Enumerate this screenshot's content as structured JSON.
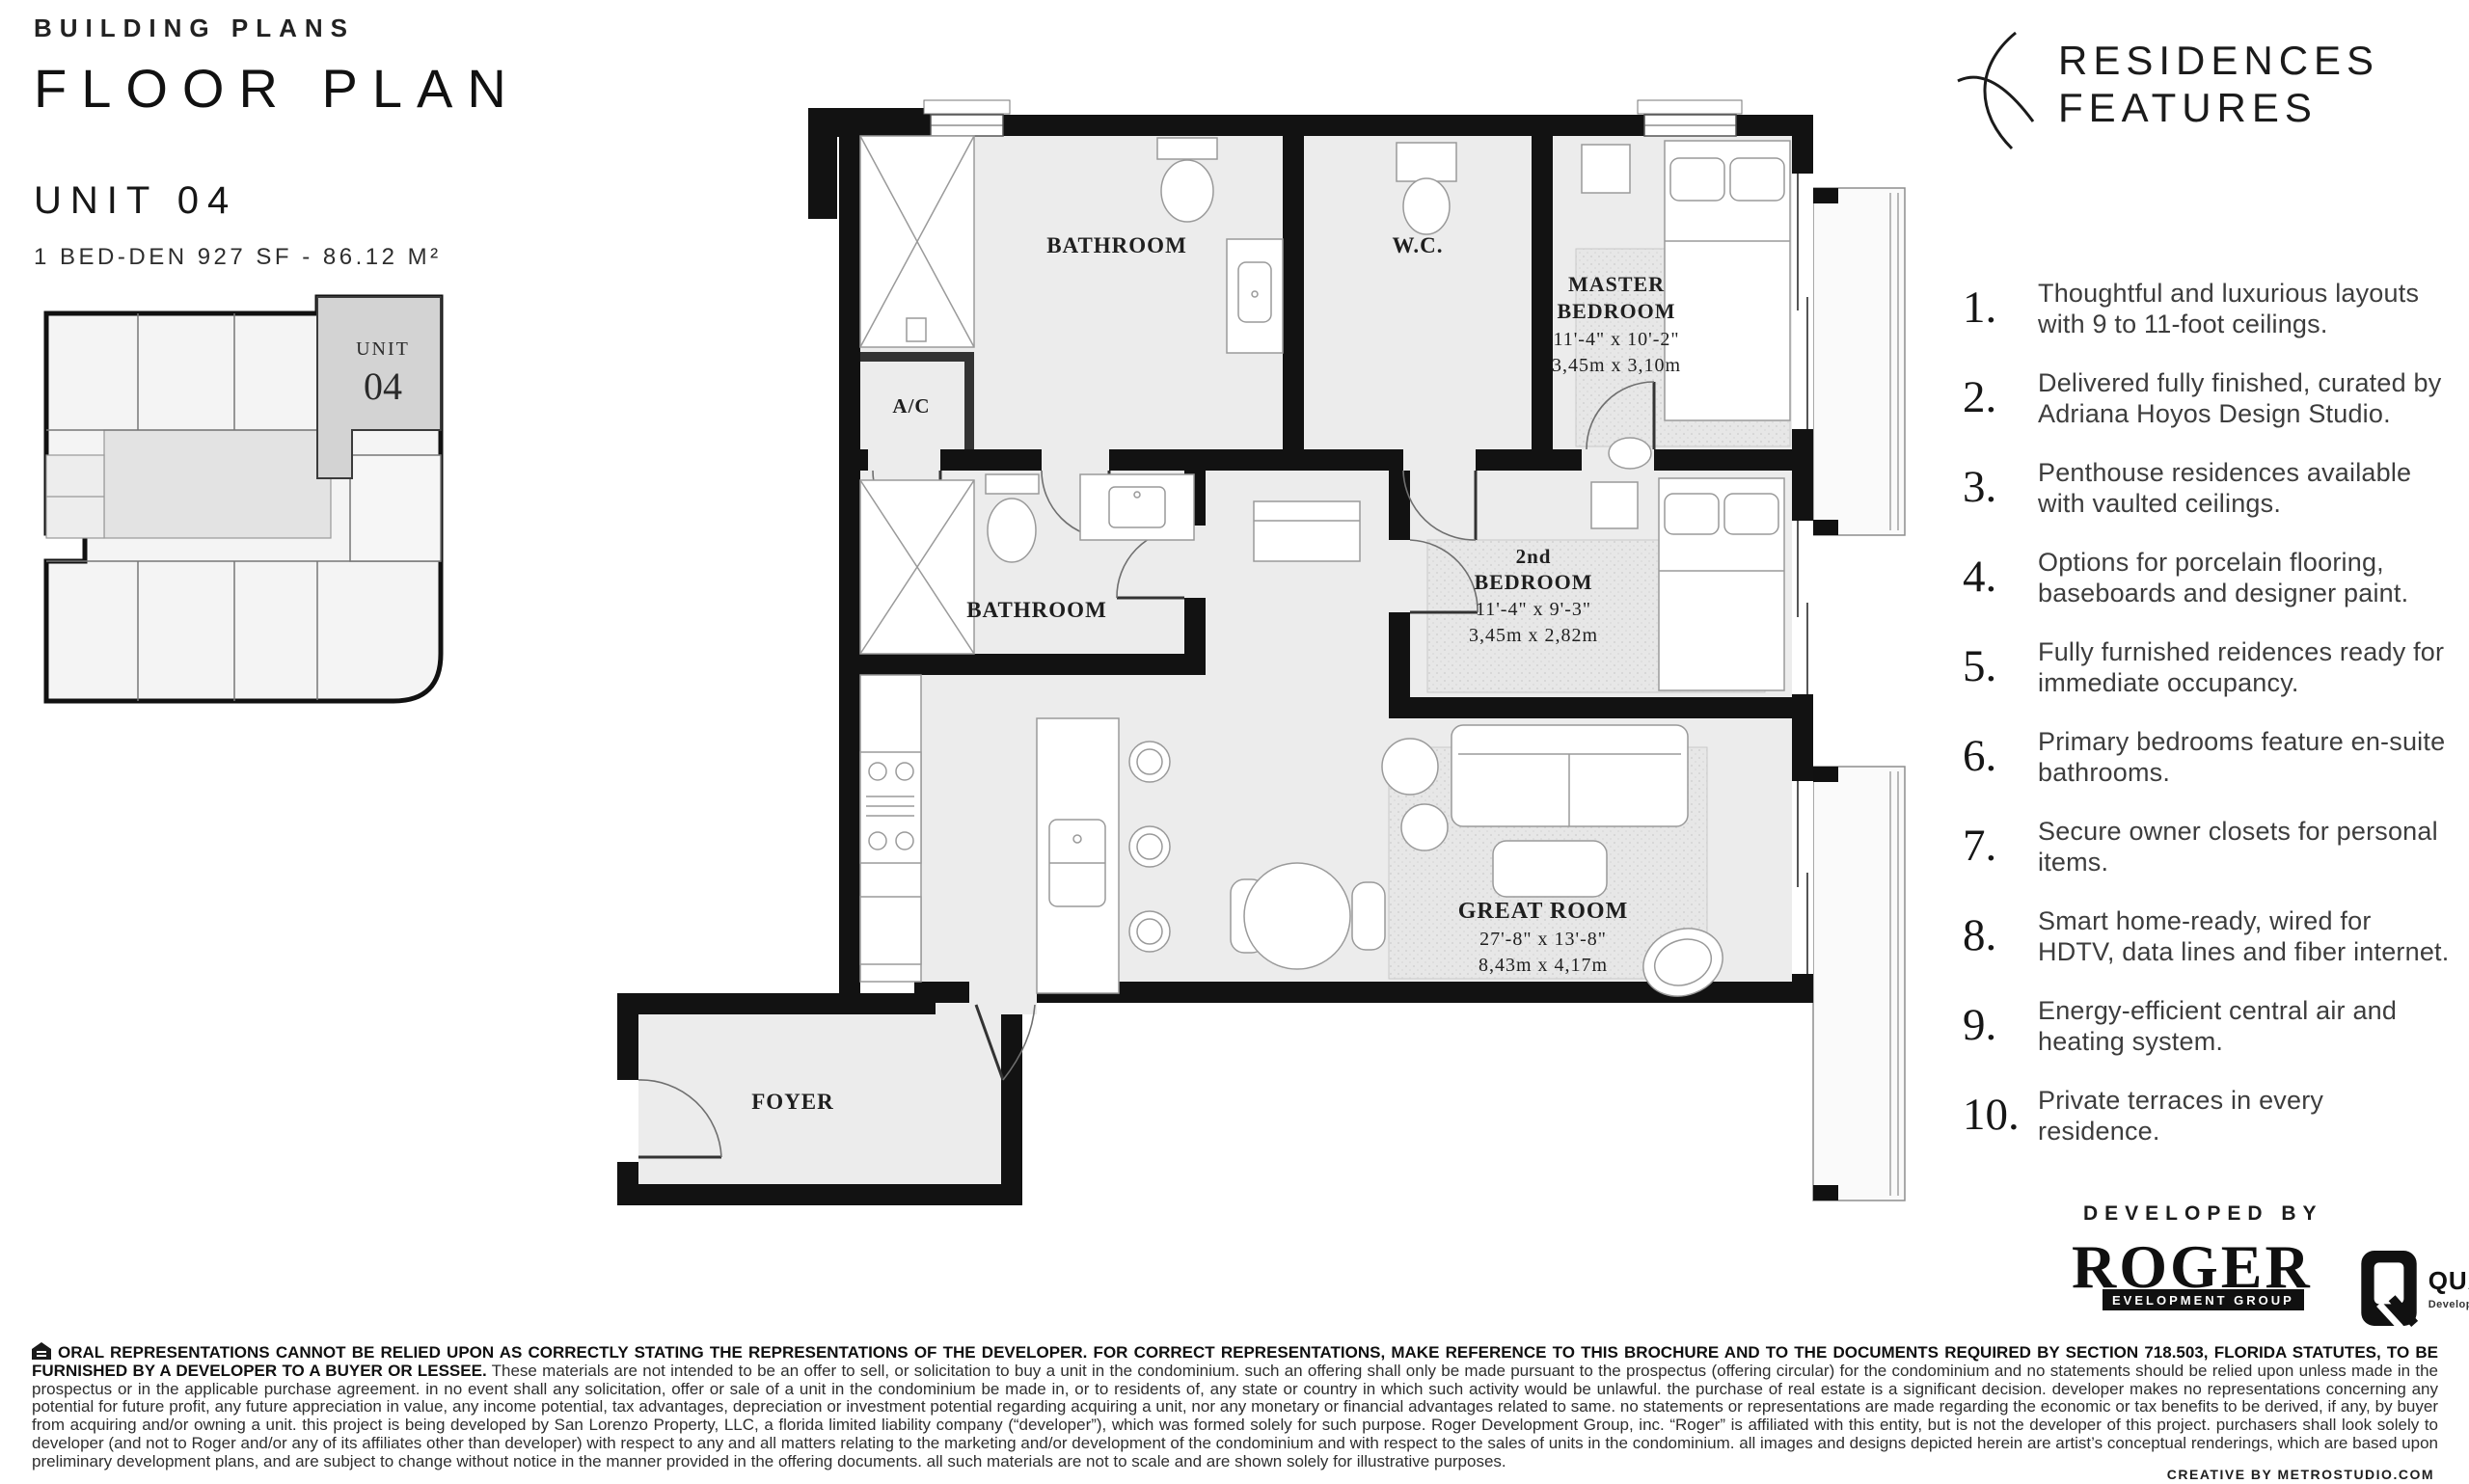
{
  "header": {
    "eyebrow": "BUILDING PLANS",
    "title": "FLOOR PLAN",
    "unit": "UNIT 04",
    "unit_specs": "1 BED-DEN 927 SF - 86.12 M²"
  },
  "keyplan": {
    "unit_label": "UNIT",
    "unit_number": "04"
  },
  "floorplan": {
    "rooms": {
      "bathroom1": "BATHROOM",
      "wc": "W.C.",
      "ac": "A/C",
      "bathroom2": "BATHROOM",
      "foyer": "FOYER",
      "master": {
        "line1": "MASTER",
        "line2": "BEDROOM",
        "imperial": "11'-4\" x 10'-2\"",
        "metric": "3,45m x 3,10m"
      },
      "bedroom2": {
        "line1": "2nd",
        "line2": "BEDROOM",
        "imperial": "11'-4\" x 9'-3\"",
        "metric": "3,45m x 2,82m"
      },
      "greatroom": {
        "line1": "GREAT ROOM",
        "imperial": "27'-8\" x 13'-8\"",
        "metric": "8,43m x 4,17m"
      }
    }
  },
  "features": {
    "logo_line1": "RESIDENCES",
    "logo_line2": "FEATURES",
    "items": [
      {
        "num": "1.",
        "text": "Thoughtful and luxurious layouts with 9 to 11-foot ceilings."
      },
      {
        "num": "2.",
        "text": "Delivered fully finished, curated by Adriana Hoyos Design Studio."
      },
      {
        "num": "3.",
        "text": "Penthouse residences available with vaulted ceilings."
      },
      {
        "num": "4.",
        "text": "Options for porcelain flooring, baseboards and designer paint."
      },
      {
        "num": "5.",
        "text": "Fully furnished reidences ready for immediate occupancy."
      },
      {
        "num": "6.",
        "text": "Primary bedrooms feature en-suite bathrooms."
      },
      {
        "num": "7.",
        "text": "Secure owner closets for personal items."
      },
      {
        "num": "8.",
        "text": "Smart home-ready, wired for HDTV, data lines and fiber internet."
      },
      {
        "num": "9.",
        "text": "Energy-efficient central air and heating system."
      },
      {
        "num": "10.",
        "text": "Private terraces in every residence."
      }
    ]
  },
  "developed_by": {
    "label": "DEVELOPED BY",
    "roger_word": "ROGER",
    "roger_sub": "EVELOPMENT GROUP",
    "quaddra_name": "QUADDRA",
    "quaddra_sub": "Development Group"
  },
  "disclaimer": {
    "bold": "ORAL REPRESENTATIONS CANNOT BE RELIED UPON AS CORRECTLY STATING THE REPRESENTATIONS OF THE DEVELOPER. FOR CORRECT REPRESENTATIONS, MAKE REFERENCE TO THIS BROCHURE AND TO THE DOCUMENTS REQUIRED BY SECTION 718.503, FLORIDA STATUTES, TO BE FURNISHED BY A DEVELOPER TO A BUYER OR LESSEE.",
    "body": " These materials are not intended to be an offer to sell, or solicitation to buy a unit in the condominium. such an offering shall only be made pursuant to the prospectus (offering circular) for the condominium and no statements should be relied upon unless made in the prospectus or in the applicable purchase agreement. in no event shall any solicitation, offer or sale of a unit in the condominium be made in, or to residents of, any state or country in which such activity would be unlawful. the purchase of real estate is a significant decision. developer makes no representations concerning any potential for future profit, any future appreciation in value, any income potential, tax advantages, depreciation or investment potential regarding acquiring a unit, nor any monetary or financial advantages related to same. no statements or representations are made regarding the economic or tax benefits to be derived, if any, by buyer from acquiring and/or owning a unit. this project is being developed by San Lorenzo Property, LLC, a florida limited liability company (“developer”), which was formed solely for such purpose. Roger Development Group, inc. “Roger” is affiliated with this entity, but is not the developer of this project. purchasers shall look solely to developer (and not to Roger and/or any of its affiliates other than developer) with respect to any and all matters relating to the marketing and/or development of the condominium and with respect to the sales of units in the condominium. all images and designs depicted herein are artist’s conceptual renderings, which are based upon preliminary development plans, and are subject to change without notice in the manner provided in the offering documents. all such materials are not to scale and are shown solely for illustrative purposes."
  },
  "credit": "CREATIVE BY METROSTUDIO.COM"
}
